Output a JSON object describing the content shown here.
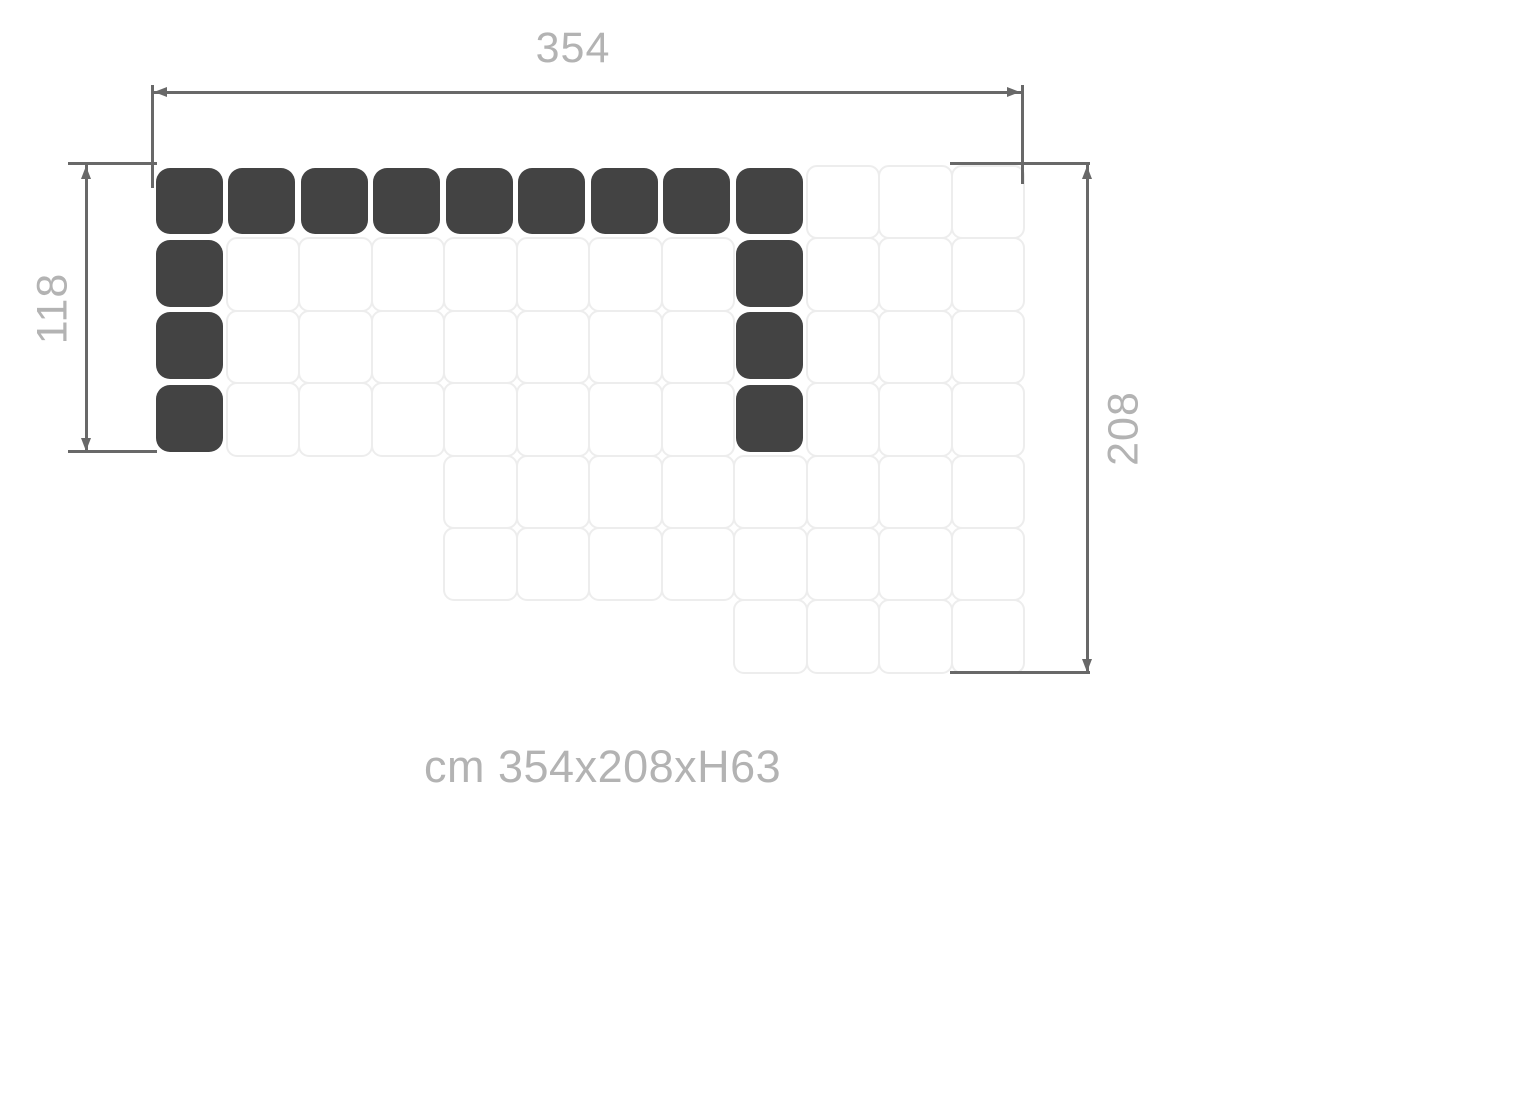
{
  "diagram": {
    "type": "sofa-floorplan",
    "grid_cols": 12,
    "grid_rows": 7,
    "regions": [
      {
        "name": "top-block",
        "col_start": 1,
        "col_end": 12,
        "row_start": 1,
        "row_end": 4
      },
      {
        "name": "middle-block",
        "col_start": 5,
        "col_end": 12,
        "row_start": 5,
        "row_end": 6
      },
      {
        "name": "bottom-block",
        "col_start": 9,
        "col_end": 12,
        "row_start": 7,
        "row_end": 7
      }
    ],
    "dark_cells": [
      [
        1,
        1
      ],
      [
        2,
        1
      ],
      [
        3,
        1
      ],
      [
        4,
        1
      ],
      [
        5,
        1
      ],
      [
        6,
        1
      ],
      [
        7,
        1
      ],
      [
        8,
        1
      ],
      [
        9,
        1
      ],
      [
        1,
        2
      ],
      [
        1,
        3
      ],
      [
        1,
        4
      ],
      [
        9,
        2
      ],
      [
        9,
        3
      ],
      [
        9,
        4
      ]
    ]
  },
  "dimensions": {
    "width": {
      "label": "354",
      "unit": "cm",
      "side": "top"
    },
    "left_height": {
      "label": "118",
      "unit": "cm",
      "side": "left"
    },
    "right_height": {
      "label": "208",
      "unit": "cm",
      "side": "right"
    }
  },
  "caption": "cm 354x208xH63",
  "colors": {
    "module_dark": "#434343",
    "cell_border": "#ededed",
    "dimension_line": "#686868",
    "label_text": "#b3b3b3"
  }
}
